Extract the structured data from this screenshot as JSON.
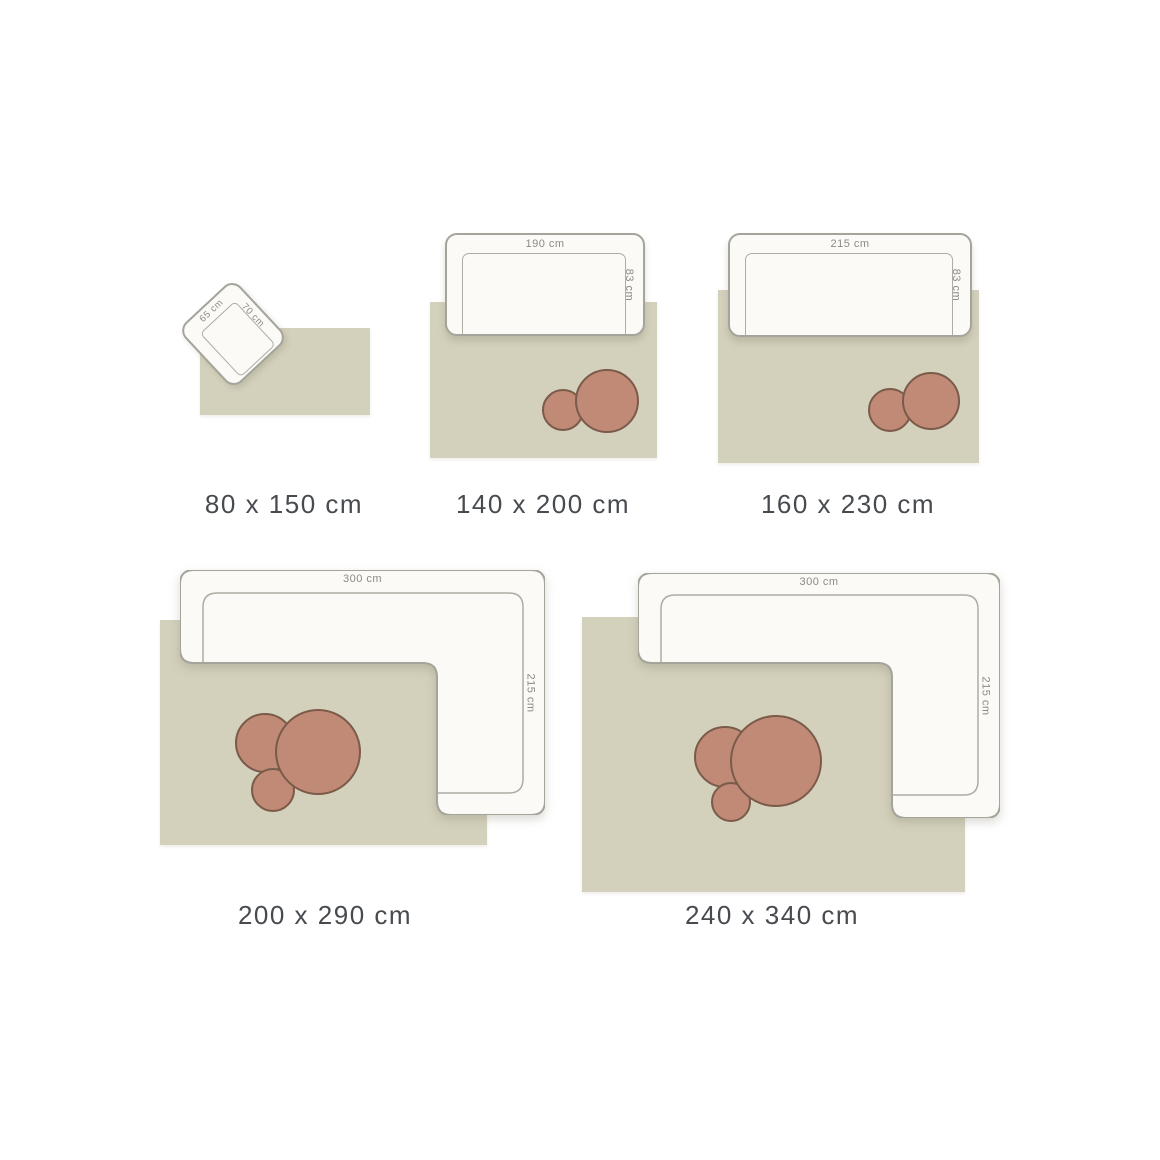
{
  "colors": {
    "background": "#ffffff",
    "rug": "#d3d0bc",
    "furniture_fill": "#fbfaf7",
    "furniture_stroke": "#a5a49b",
    "table_fill": "#c08a76",
    "table_stroke": "#7a5b49",
    "size_label_text": "#474b50",
    "dimension_label_text": "#8b8b85"
  },
  "diagrams": [
    {
      "size_label": "80 x 150 cm",
      "furniture": {
        "type": "armchair",
        "width_label": "65 cm",
        "depth_label": "70 cm"
      },
      "tables": []
    },
    {
      "size_label": "140 x 200 cm",
      "furniture": {
        "type": "sofa",
        "width_label": "190 cm",
        "depth_label": "83 cm"
      },
      "tables": [
        "small",
        "large"
      ]
    },
    {
      "size_label": "160 x 230 cm",
      "furniture": {
        "type": "sofa",
        "width_label": "215 cm",
        "depth_label": "83 cm"
      },
      "tables": [
        "small",
        "large"
      ]
    },
    {
      "size_label": "200 x 290 cm",
      "furniture": {
        "type": "corner-sofa",
        "width_label": "300 cm",
        "depth_label": "215 cm"
      },
      "tables": [
        "medium",
        "small",
        "large"
      ]
    },
    {
      "size_label": "240 x 340 cm",
      "furniture": {
        "type": "corner-sofa",
        "width_label": "300 cm",
        "depth_label": "215 cm"
      },
      "tables": [
        "medium",
        "small",
        "large"
      ]
    }
  ]
}
